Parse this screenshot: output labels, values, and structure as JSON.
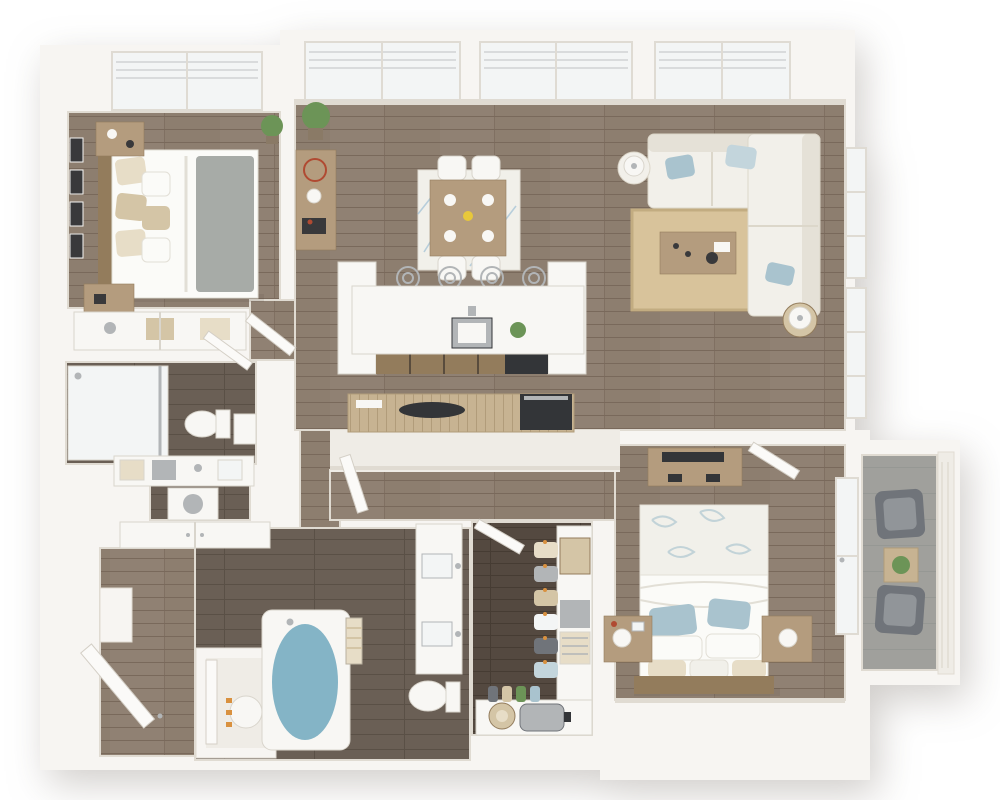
{
  "scene": {
    "title": "3D top-down apartment floor plan render",
    "style": "photoreal dollhouse view, white walls, wood floors",
    "text_visible_in_image": "none"
  },
  "palette": {
    "wall": "#f7f5f2",
    "wall_face": "#efece6",
    "wall_edge": "#e0dbd2",
    "floor_wood": "#8d7e6f",
    "floor_plank": "#79695b",
    "floor_wood_hi": "#9c8d7d",
    "tile": "#6a5f55",
    "tile_line": "#5a5046",
    "closet_floor": "#544940",
    "closet_line": "#463c33",
    "counter_wood": "#c7b392",
    "counter_line": "#b19c7a",
    "concrete": "#a0a09c",
    "concrete_line": "#909290",
    "window_glass": "#f3f5f5",
    "window_frame": "#dfdbd3",
    "blind_line": "#d9dbdc",
    "fixture_white": "#f8f7f4",
    "fixture_stroke": "#d9d5cc",
    "steel": "#b2b5b7",
    "appliance": "#333538",
    "sofa": "#f2f0ea",
    "sofa_line": "#dcd7ca",
    "pillow_blue": "#a9c3ce",
    "pillow_blue_lt": "#c3d5dc",
    "rug_jute": "#d8c39b",
    "rug_jute_line": "#c2ac81",
    "rug_white": "#f1f0ea",
    "rug_line": "#b7cedb",
    "wood_furn": "#b49c7e",
    "wood_furn_dark": "#937c5c",
    "bed_white": "#fbfbf8",
    "bed_fold": "#e2dfd6",
    "throw_gray": "#a7aba7",
    "pillow_cream": "#e7ddc7",
    "pillow_tan": "#d4c5a6",
    "water": "#84b4c6",
    "plant": "#6c9457",
    "pot": "#8a7a66",
    "hanger": "#d9913f",
    "door_white": "#fbfaf8",
    "door_stroke": "#d4cfc6",
    "shadow": "rgba(70,58,45,0.10)",
    "black_decor": "#39393b",
    "red_accent": "#b04a32",
    "flower_yellow": "#e8c83a",
    "chair_gray": "#70747a"
  },
  "rooms": [
    {
      "id": "bedroom-1",
      "name": "Bedroom 1",
      "floor": "wood",
      "position": "top-left"
    },
    {
      "id": "closet-1",
      "name": "Reach-in closet",
      "floor": "shelf",
      "position": "left"
    },
    {
      "id": "bathroom-1",
      "name": "Bathroom 1",
      "floor": "dark tile",
      "position": "left-middle"
    },
    {
      "id": "laundry",
      "name": "Laundry / linen area",
      "floor": "dark tile",
      "position": "left"
    },
    {
      "id": "entry",
      "name": "Entry hall",
      "floor": "wood",
      "position": "bottom-left"
    },
    {
      "id": "utility-closet",
      "name": "Utility closet (water heater)",
      "floor": "wood",
      "position": "bottom-left"
    },
    {
      "id": "dining-area",
      "name": "Dining area",
      "floor": "wood",
      "position": "top-middle"
    },
    {
      "id": "kitchen",
      "name": "Kitchen with island",
      "floor": "wood",
      "position": "middle"
    },
    {
      "id": "living-room",
      "name": "Living room",
      "floor": "wood",
      "position": "top-right"
    },
    {
      "id": "hallway",
      "name": "Hallway",
      "floor": "wood",
      "position": "middle"
    },
    {
      "id": "bathroom-2",
      "name": "Bathroom 2 (tub + double vanity)",
      "floor": "dark tile",
      "position": "bottom-middle"
    },
    {
      "id": "walk-in-closet",
      "name": "Walk-in closet",
      "floor": "dark wood",
      "position": "bottom-middle"
    },
    {
      "id": "bedroom-2",
      "name": "Bedroom 2",
      "floor": "wood",
      "position": "bottom-right"
    },
    {
      "id": "balcony",
      "name": "Balcony",
      "floor": "concrete",
      "position": "right"
    }
  ],
  "furniture": {
    "bedroom_1": [
      "queen bed with gray throw",
      "nightstand x2",
      "wall art x4",
      "potted plant",
      "window with blinds",
      "closet with folded linens",
      "door"
    ],
    "dining_area": [
      "dining table",
      "dining chairs x4",
      "place settings x4",
      "yellow centerpiece",
      "geometric rug",
      "console table with decor",
      "tall plant"
    ],
    "kitchen": [
      "white island",
      "bar stools x4",
      "undermount sink",
      "island plant",
      "base drawers",
      "dishwasher",
      "wood counter",
      "cooktop",
      "range"
    ],
    "living_room": [
      "white L sectional sofa",
      "blue accent pillows x4",
      "jute rug",
      "coffee table with decor",
      "round side table with lamp x2",
      "tall windows"
    ],
    "bathroom_1": [
      "glass shower",
      "toilet",
      "storage cabinet",
      "vanity with baskets",
      "washer",
      "linen closet",
      "door"
    ],
    "entry": [
      "front door",
      "water heater with orange valves",
      "utility door"
    ],
    "bathroom_2": [
      "soaking tub with water",
      "rolled towels",
      "double vanity",
      "toilet",
      "door"
    ],
    "walk_in_closet": [
      "hanging clothes with orange hangers",
      "storage boxes x3",
      "shoe row",
      "sun hat",
      "suitcase",
      "door"
    ],
    "bedroom_2": [
      "queen bed with leaf-print blanket",
      "blue pillows",
      "nightstand with lamp x2",
      "media console with TV",
      "door",
      "glass balcony door"
    ],
    "balcony": [
      "lounge chairs x2",
      "wood side table with plant",
      "railing"
    ]
  }
}
